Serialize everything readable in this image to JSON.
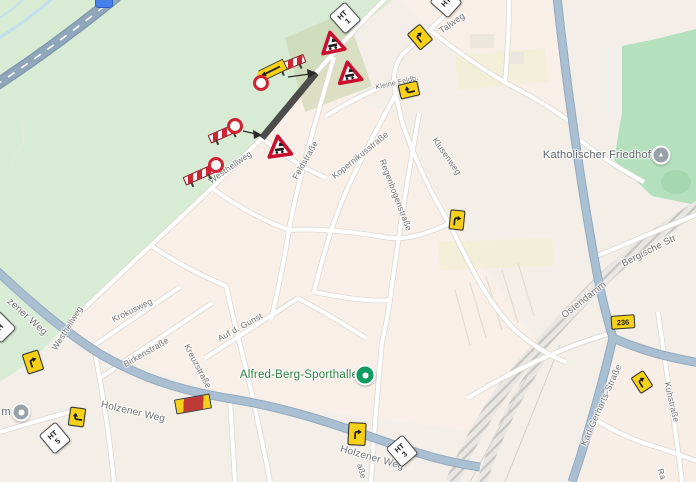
{
  "map": {
    "description": "street map with road construction closure and detour signage",
    "colors": {
      "background": "#f3efe8",
      "urban_block": "#f9efe9",
      "park": "#d7ebd5",
      "cemetery": "#b4e0bd",
      "construction_zone": "#c9d3ab",
      "road_major": "#aabfd2",
      "highway": "#8fa6bb",
      "closed_road": "#4c4c4c",
      "railway": "#c7c5c1",
      "water": "#c3dfee",
      "sign_red": "#cf2333",
      "sign_yellow": "#f7d117",
      "poi_green": "#0e9c63",
      "label_green": "#2d8044",
      "label_gray": "#707070"
    }
  },
  "labels": [
    {
      "text": "Talweg",
      "x": 452,
      "y": 23,
      "rot": -35,
      "size": 9
    },
    {
      "text": "Kleine Feldb.",
      "x": 397,
      "y": 83,
      "rot": -13,
      "size": 7
    },
    {
      "text": "Westhellweg",
      "x": 230,
      "y": 167,
      "rot": -35
    },
    {
      "text": "Feldstraße",
      "x": 305,
      "y": 160,
      "rot": -60
    },
    {
      "text": "Kopernikusstraße",
      "x": 360,
      "y": 155,
      "rot": -39
    },
    {
      "text": "Regenbogenstraße",
      "x": 396,
      "y": 195,
      "rot": 69
    },
    {
      "text": "Klusenweg",
      "x": 447,
      "y": 156,
      "rot": 55
    },
    {
      "text": "Bergische Str",
      "x": 649,
      "y": 251,
      "rot": -27,
      "size": 9.5
    },
    {
      "text": "Ostendamm",
      "x": 584,
      "y": 300,
      "rot": -38,
      "size": 9.5
    },
    {
      "text": "zener Weg",
      "x": 27,
      "y": 317,
      "rot": 42,
      "size": 10
    },
    {
      "text": "Westhellweg",
      "x": 67,
      "y": 328,
      "rot": -58
    },
    {
      "text": "Krokusweg",
      "x": 132,
      "y": 310,
      "rot": -26
    },
    {
      "text": "Birkenstraße",
      "x": 146,
      "y": 352,
      "rot": -30
    },
    {
      "text": "Auf d. Gunst",
      "x": 240,
      "y": 327,
      "rot": -29
    },
    {
      "text": "Kreuzstraße",
      "x": 198,
      "y": 366,
      "rot": 62
    },
    {
      "text": "Holzener Weg",
      "x": 133,
      "y": 412,
      "rot": 13,
      "size": 10
    },
    {
      "text": "Holzener Weg",
      "x": 372,
      "y": 458,
      "rot": 16,
      "size": 10
    },
    {
      "text": "Karl-Gerharts-Straße",
      "x": 601,
      "y": 405,
      "rot": -66,
      "size": 9
    },
    {
      "text": "Kuhstraße",
      "x": 672,
      "y": 402,
      "rot": 77
    },
    {
      "text": "aße",
      "x": 362,
      "y": 471,
      "rot": 75
    },
    {
      "text": "Ra",
      "x": 662,
      "y": 474,
      "rot": 72
    },
    {
      "text": "Katholischer Friedhof",
      "x": 597,
      "y": 155,
      "rot": 0,
      "cls": "poi-gray",
      "size": 11
    },
    {
      "text": "m",
      "x": 6,
      "y": 412,
      "rot": 0,
      "cls": "poi-gray",
      "size": 11
    },
    {
      "text": "Alfred-Berg-Sporthalle",
      "x": 299,
      "y": 375,
      "rot": 0,
      "cls": "poi-green",
      "size": 11.5
    }
  ],
  "markers": {
    "triangles": [
      {
        "x": 332,
        "y": 42,
        "rot": -12
      },
      {
        "x": 349,
        "y": 72,
        "rot": -10
      },
      {
        "x": 279,
        "y": 146,
        "rot": -8
      }
    ],
    "barriers": [
      {
        "x": 290,
        "y": 64,
        "rot": -22
      },
      {
        "x": 224,
        "y": 133,
        "rot": -24
      },
      {
        "x": 199,
        "y": 175,
        "rot": -24
      }
    ],
    "rings": [
      {
        "x": 261,
        "y": 83
      },
      {
        "x": 235,
        "y": 126
      },
      {
        "x": 216,
        "y": 165
      }
    ],
    "yellow_signs": [
      {
        "x": 420,
        "y": 37,
        "rot": -40,
        "w": 15,
        "h": 19,
        "glyph_rot": 0
      },
      {
        "x": 409,
        "y": 90,
        "rot": -13,
        "w": 18,
        "h": 13,
        "glyph_rot": -90
      },
      {
        "x": 457,
        "y": 220,
        "rot": 6,
        "w": 13,
        "h": 18,
        "glyph_rot": 0
      },
      {
        "x": 33,
        "y": 362,
        "rot": -18,
        "w": 15,
        "h": 19,
        "glyph_rot": 0
      },
      {
        "x": 77,
        "y": 417,
        "rot": 8,
        "w": 14,
        "h": 17,
        "glyph_rot": -90
      },
      {
        "x": 357,
        "y": 434,
        "rot": 3,
        "w": 16,
        "h": 21,
        "glyph_rot": 0
      },
      {
        "x": 642,
        "y": 382,
        "rot": -33,
        "w": 13,
        "h": 17,
        "glyph_rot": 0
      }
    ],
    "ht_signs": [
      {
        "x": 345,
        "y": 18,
        "rot": -42,
        "lines": [
          "HT",
          "1"
        ]
      },
      {
        "x": 446,
        "y": 2,
        "rot": -48,
        "lines": [
          "HT"
        ]
      },
      {
        "x": 55,
        "y": 438,
        "rot": -40,
        "lines": [
          "HT",
          "5"
        ]
      },
      {
        "x": 402,
        "y": 451,
        "rot": -40,
        "lines": [
          "HT",
          "3"
        ]
      },
      {
        "x": 0,
        "y": 327,
        "rot": -45,
        "lines": [
          "H"
        ]
      }
    ],
    "shield": {
      "text": "236",
      "x": 623,
      "y": 322,
      "rot": -4
    },
    "detour_sign": {
      "x": 271,
      "y": 71,
      "rot": -26
    },
    "detour_end_sign": {
      "x": 193,
      "y": 404,
      "rot": -10
    }
  },
  "pois": [
    {
      "type": "sport",
      "x": 365,
      "y": 375
    },
    {
      "type": "cemetery",
      "x": 661,
      "y": 155
    },
    {
      "type": "gray",
      "x": 21,
      "y": 412
    },
    {
      "type": "blue",
      "x": 104,
      "y": 1
    }
  ]
}
